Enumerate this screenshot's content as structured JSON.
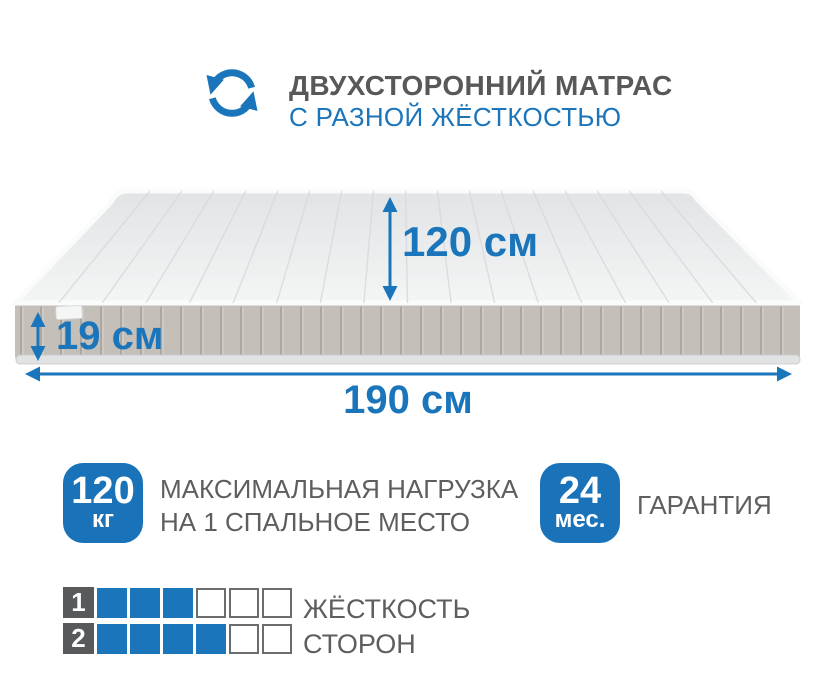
{
  "colors": {
    "accent": "#1b75bb",
    "badge_blue": "#1a73b8",
    "title_gray": "#57585a",
    "text_gray": "#5d5e60",
    "mattress_top": "#eceef0",
    "mattress_side": "#c5bfba"
  },
  "header": {
    "icon": "rotate-arrows-icon",
    "title": "ДВУХСТОРОННИЙ МАТРАС",
    "subtitle": "С РАЗНОЙ ЖЁСТКОСТЬЮ"
  },
  "dimensions": {
    "width": "120 см",
    "height": "19 см",
    "length": "190 см"
  },
  "max_load": {
    "value": "120",
    "unit": "кг",
    "line1": "МАКСИМАЛЬНАЯ НАГРУЗКА",
    "line2": "НА 1 СПАЛЬНОЕ МЕСТО"
  },
  "warranty": {
    "value": "24",
    "unit": "мес.",
    "label": "ГАРАНТИЯ"
  },
  "firmness": {
    "label_line1": "ЖЁСТКОСТЬ",
    "label_line2": "СТОРОН",
    "rows": [
      {
        "label": "1",
        "filled": 3,
        "total": 6
      },
      {
        "label": "2",
        "filled": 4,
        "total": 6
      }
    ]
  }
}
